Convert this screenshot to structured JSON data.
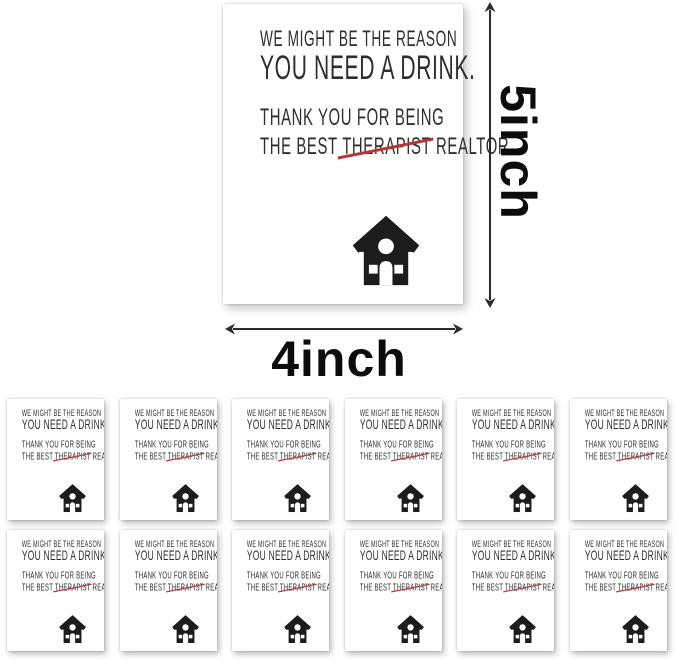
{
  "card": {
    "line1": "WE MIGHT BE THE REASON",
    "line2": "YOU NEED A DRINK.",
    "line3": "THANK YOU FOR BEING",
    "line4_prefix": "THE BEST ",
    "line4_struck": "THERAPIST",
    "line4_suffix": " REALTOR.",
    "icon": "house-icon",
    "text_color": "#2e2e2e",
    "strike_color": "#b93535",
    "background_color": "#ffffff"
  },
  "dimensions": {
    "height_label": "5inch",
    "width_label": "4inch",
    "arrow_color": "#2a2a2a"
  },
  "grid": {
    "rows": 2,
    "columns": 6,
    "total_cards": 12
  }
}
